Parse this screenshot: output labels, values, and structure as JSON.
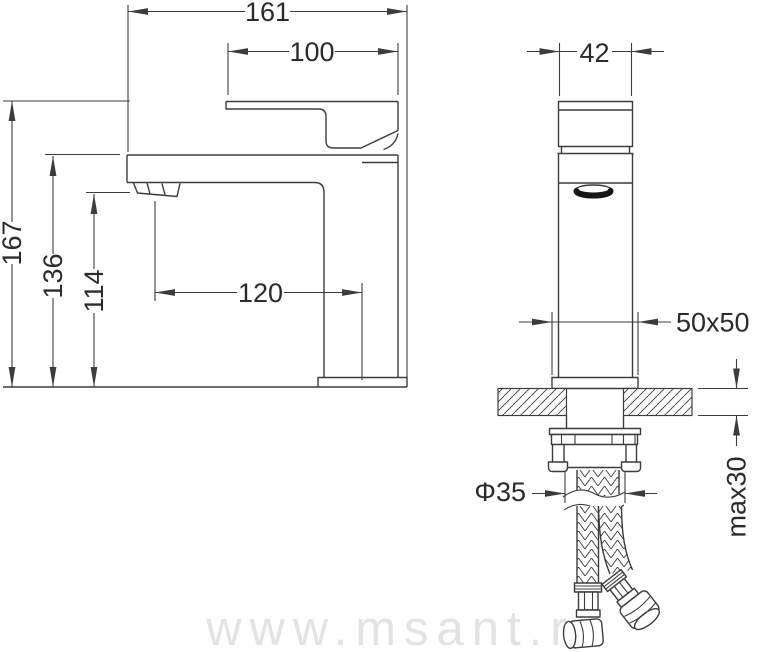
{
  "drawing": {
    "watermark": "www.msant.ru",
    "side_view": {
      "total_length": "161",
      "handle_length": "100",
      "total_height": "167",
      "spout_top_height": "136",
      "aerator_height": "114",
      "spout_reach": "120"
    },
    "front_view": {
      "body_width": "42",
      "base_plate": "50x50",
      "hole_diameter": "Φ35",
      "max_mount_thickness": "max30"
    },
    "colors": {
      "line": "#3c3c3c",
      "text": "#2b2b2b",
      "watermark": "#e3e3e3",
      "aerator": "#151515",
      "background": "#ffffff"
    }
  }
}
